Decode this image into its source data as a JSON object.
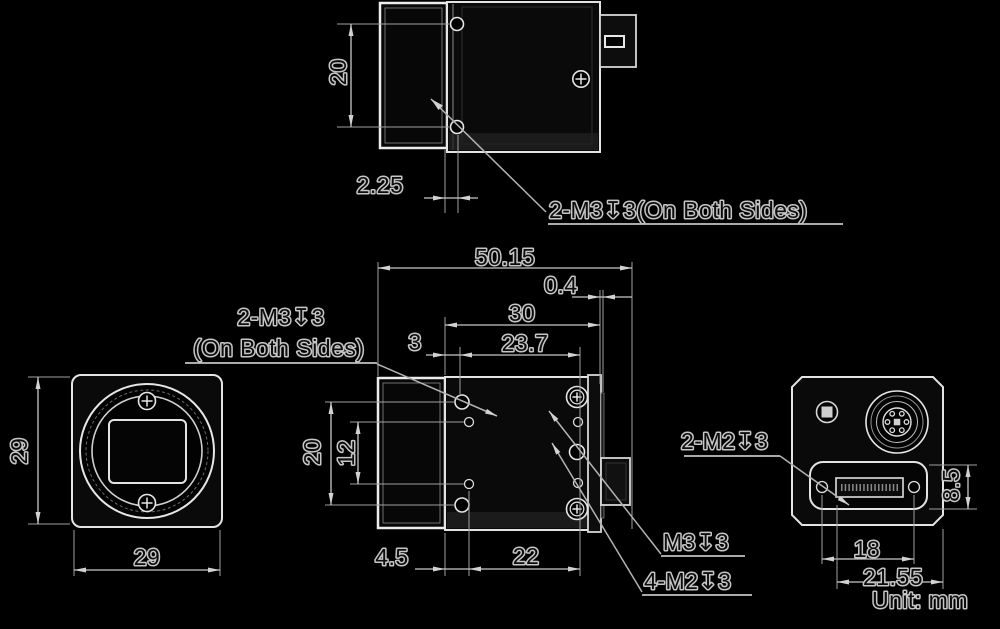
{
  "drawing": {
    "unit_label": "Unit: mm",
    "colors": {
      "background": "#000000",
      "outline": "#e6e6e6",
      "dimension_lines": "#c8c8c8",
      "extension_lines": "#9f9f9f",
      "text_fill": "#0d0d0d",
      "text_halo": "#c6c6c6"
    },
    "top_view": {
      "dim_hole_spacing": "20",
      "dim_hole_offset": "2.25",
      "label_side_holes": "2-M3↧3(On Both Sides)"
    },
    "side_view": {
      "dim_overall_length": "50.15",
      "dim_back_step": "0.4",
      "dim_body_depth": "30",
      "dim_front_offset": "3",
      "dim_hole_span": "23.7",
      "dim_hole_v_outer": "20",
      "dim_hole_v_inner": "12",
      "dim_bottom_front": "4.5",
      "dim_bottom_span": "22",
      "label_m3_line1": "2-M3↧3",
      "label_m3_line2": "(On Both Sides)",
      "label_m3_single": "M3↧3",
      "label_m2_four": "4-M2↧3"
    },
    "front_view": {
      "dim_height": "29",
      "dim_width": "29"
    },
    "back_view": {
      "label_m2_pair": "2-M2↧3",
      "dim_connector_height": "8.5",
      "dim_screw_spacing": "18",
      "dim_connector_width": "21.55"
    }
  }
}
